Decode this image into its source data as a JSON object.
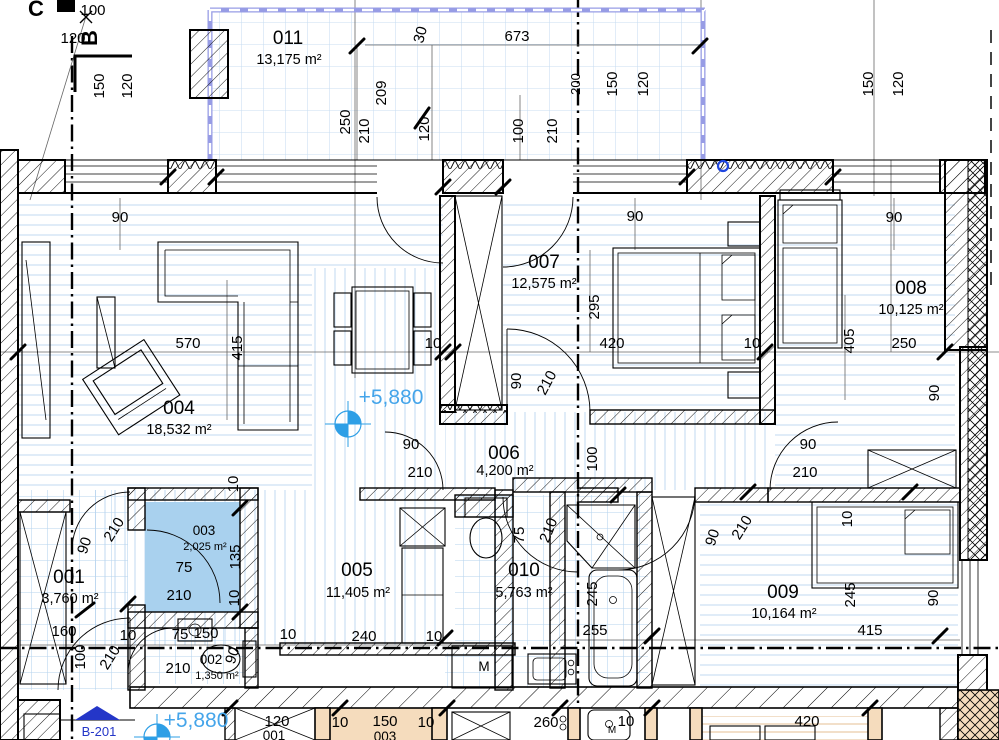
{
  "rooms": [
    {
      "num": "011",
      "area": "13,175 m²"
    },
    {
      "num": "004",
      "area": "18,532 m²"
    },
    {
      "num": "007",
      "area": "12,575 m²"
    },
    {
      "num": "008",
      "area": "10,125 m²"
    },
    {
      "num": "006",
      "area": "4,200 m²"
    },
    {
      "num": "005",
      "area": "11,405 m²"
    },
    {
      "num": "010",
      "area": "5,763 m²"
    },
    {
      "num": "009",
      "area": "10,164 m²"
    },
    {
      "num": "003",
      "area": "2,025 m²"
    },
    {
      "num": "001",
      "area": "3,760 m²"
    },
    {
      "num": "002",
      "area": "1,350 m²"
    },
    {
      "num": "001"
    },
    {
      "num": "003"
    }
  ],
  "markers": {
    "level_upper": "+5,880",
    "level_lower": "+5,880",
    "section": "B-201",
    "axis_c": "C",
    "axis_b": "B",
    "washer": "М",
    "washer_small": "M"
  },
  "colors": {
    "floor_line": "#cbdff2",
    "tile_grid": "#b5d3ee",
    "room003_fill": "#a9d1ee",
    "balcony_rail": "#979ce5",
    "lower_unit_wall": "#f5dcbd",
    "level_blue": "#2e9fe6",
    "section_blue": "#2436c8"
  },
  "dims": [
    "100",
    "120",
    "150",
    "120",
    "673",
    "250",
    "210",
    "209",
    "30",
    "120",
    "100",
    "210",
    "200",
    "150",
    "120",
    "150",
    "120",
    "90",
    "90",
    "90",
    "570",
    "415",
    "10",
    "420",
    "10",
    "250",
    "295",
    "405",
    "90",
    "90",
    "210",
    "90",
    "210",
    "100",
    "90",
    "210",
    "75",
    "210",
    "90",
    "210",
    "10",
    "245",
    "255",
    "245",
    "415",
    "90",
    "90",
    "210",
    "10",
    "75",
    "210",
    "135",
    "10",
    "160",
    "100",
    "210",
    "10",
    "75",
    "150",
    "210",
    "90",
    "10",
    "240",
    "10",
    "260",
    "10",
    "120",
    "10",
    "150",
    "10",
    "420"
  ]
}
